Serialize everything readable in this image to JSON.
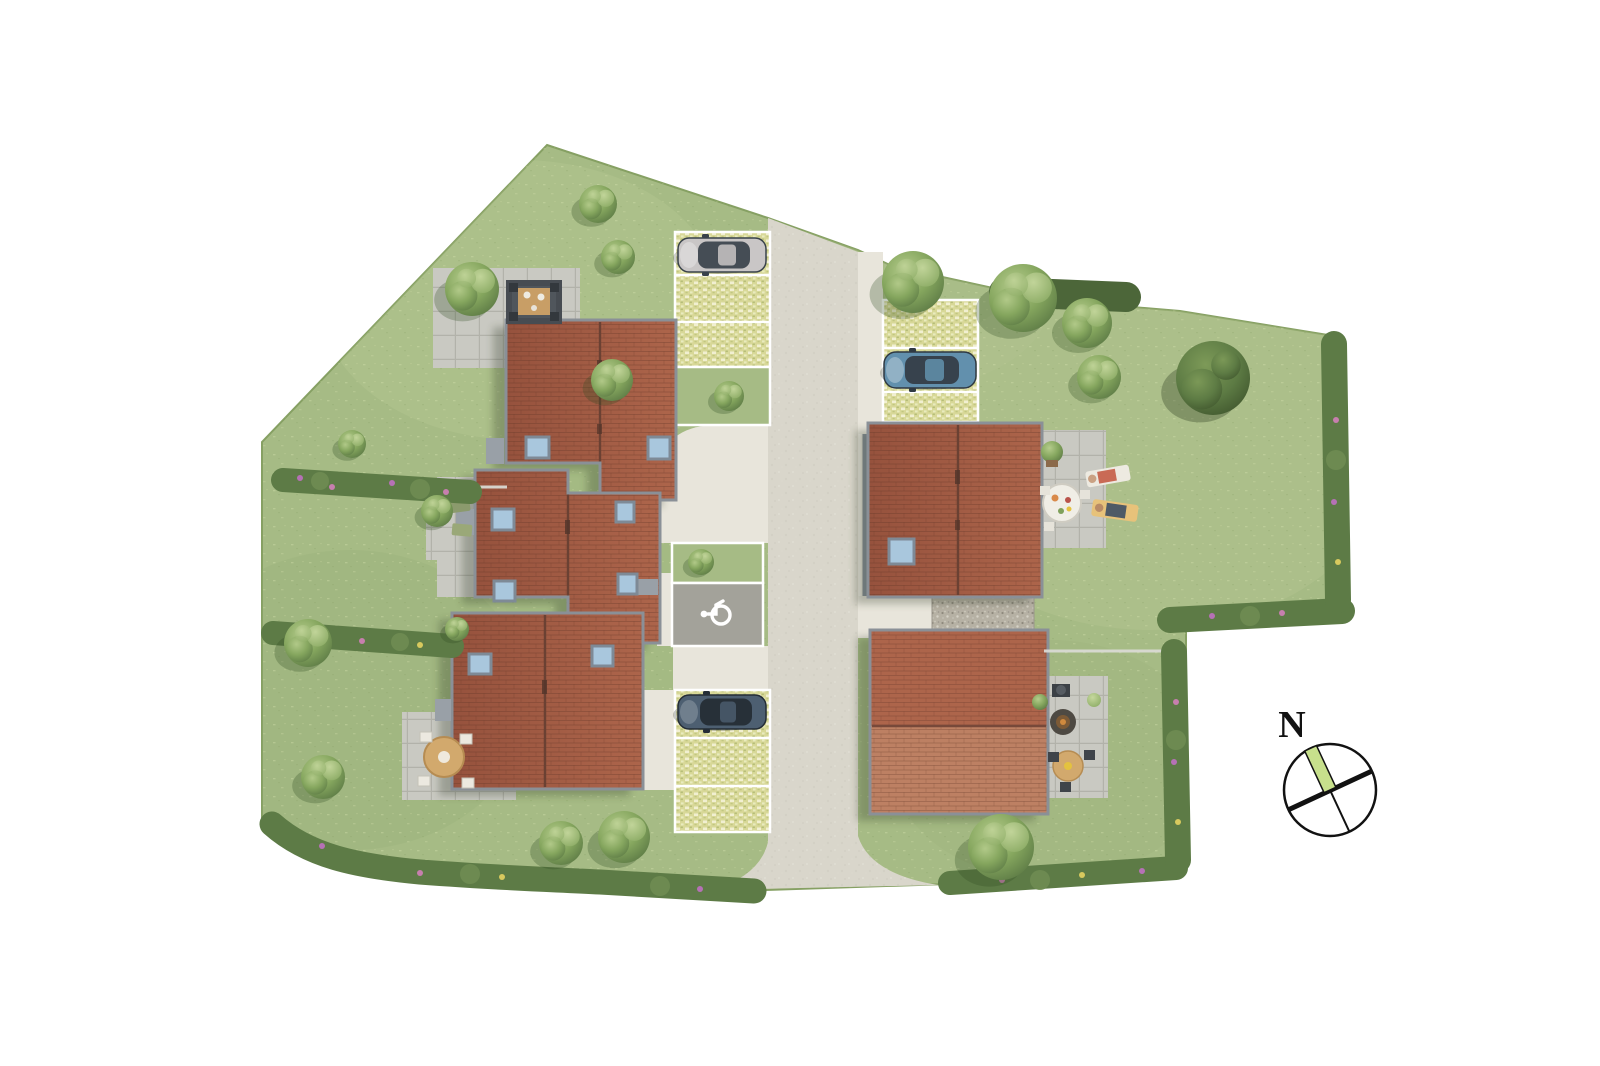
{
  "page": {
    "background": "#ffffff",
    "description": "Aerial 2D site plan of a small residential development: five tiled-roof houses, a central access road, grass-paver parking bays with three parked cars, a disabled parking space, lawns with hedges and trees, patios with outdoor furniture, and a north compass rose."
  },
  "compass": {
    "label": "N"
  },
  "colors": {
    "background": "#ffffff",
    "lawn": "#a6bb85",
    "lawn_light": "#c6d29e",
    "lawn_dark": "#8da66c",
    "road": "#d9d6cb",
    "pavement": "#e8e5db",
    "slab": "#c9c9c2",
    "slab_line": "#b2b2aa",
    "gravel": "#b6b1a4",
    "handicap_bay": "#a3a29a",
    "stall_line": "#ffffff",
    "paver": "#d8d898",
    "roof_dark": "#96523d",
    "roof_light": "#ad654b",
    "roof_pale": "#bd8063",
    "roof_joint": "#5e3326",
    "ridge": "#6b4133",
    "eave": "#8a9097",
    "porch": "#99a0a7",
    "wall": "#8b949e",
    "skylight": "#a9c7dd",
    "skylight_frame": "#7e8a96",
    "hedge": "#5d7b46",
    "hedge_dark": "#4c6639",
    "tree_light": "#b5cc8c",
    "tree_mid": "#85a65e",
    "tree_dark": "#5e7c46",
    "flower_purple": "#b671b6",
    "flower_pink": "#c77fae",
    "flower_yellow": "#d8c95e",
    "fence": "#d9d9d3",
    "wood": "#c89e66",
    "compass_green": "#c7e08c",
    "ink": "#121212"
  },
  "scene": {
    "houses": [
      "house-top-left",
      "house-middle-left",
      "house-bottom-left",
      "house-top-right",
      "house-bottom-right"
    ],
    "cars": [
      {
        "name": "silver-hatchback",
        "color": "#c9c6c6"
      },
      {
        "name": "blue-sedan",
        "color": "#6290ad"
      },
      {
        "name": "dark-blue-hatchback",
        "color": "#4d5f71"
      }
    ],
    "parking": {
      "grass_paver_bays": 3,
      "disabled_bay": true
    },
    "icons": [
      "disabled-parking-icon",
      "compass-rose-icon"
    ]
  }
}
